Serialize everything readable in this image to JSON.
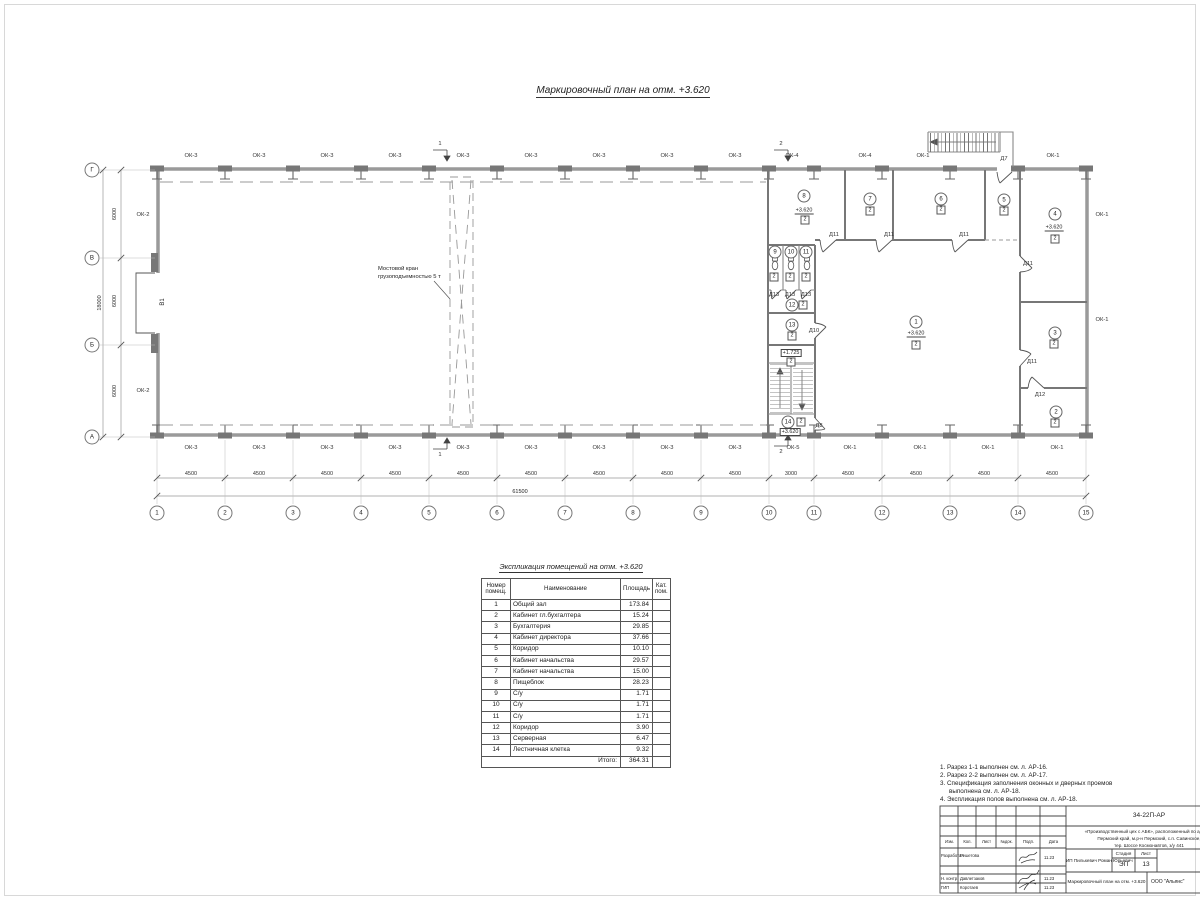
{
  "sheet": {
    "main_title": "Маркировочный план  на отм. +3.620",
    "table_title": "Экспликация помещений на отм. +3.620"
  },
  "plan": {
    "grid_cols": [
      {
        "t": "1",
        "x": 157,
        "y": 513
      },
      {
        "t": "2",
        "x": 225,
        "y": 513
      },
      {
        "t": "3",
        "x": 293,
        "y": 513
      },
      {
        "t": "4",
        "x": 361,
        "y": 513
      },
      {
        "t": "5",
        "x": 429,
        "y": 513
      },
      {
        "t": "6",
        "x": 497,
        "y": 513
      },
      {
        "t": "7",
        "x": 565,
        "y": 513
      },
      {
        "t": "8",
        "x": 633,
        "y": 513
      },
      {
        "t": "9",
        "x": 701,
        "y": 513
      },
      {
        "t": "10",
        "x": 769,
        "y": 513
      },
      {
        "t": "11",
        "x": 814,
        "y": 513
      },
      {
        "t": "12",
        "x": 882,
        "y": 513
      },
      {
        "t": "13",
        "x": 950,
        "y": 513
      },
      {
        "t": "14",
        "x": 1018,
        "y": 513
      },
      {
        "t": "15",
        "x": 1086,
        "y": 513
      }
    ],
    "grid_rows": [
      {
        "t": "Г",
        "x": 92,
        "y": 170
      },
      {
        "t": "В",
        "x": 92,
        "y": 258
      },
      {
        "t": "Б",
        "x": 92,
        "y": 345
      },
      {
        "t": "А",
        "x": 92,
        "y": 437
      }
    ],
    "span_dims": [
      {
        "t": "4500",
        "x": 191,
        "y": 474
      },
      {
        "t": "4500",
        "x": 259,
        "y": 474
      },
      {
        "t": "4500",
        "x": 327,
        "y": 474
      },
      {
        "t": "4500",
        "x": 395,
        "y": 474
      },
      {
        "t": "4500",
        "x": 463,
        "y": 474
      },
      {
        "t": "4500",
        "x": 531,
        "y": 474
      },
      {
        "t": "4500",
        "x": 599,
        "y": 474
      },
      {
        "t": "4500",
        "x": 667,
        "y": 474
      },
      {
        "t": "4500",
        "x": 735,
        "y": 474
      },
      {
        "t": "3000",
        "x": 791,
        "y": 474
      },
      {
        "t": "4500",
        "x": 848,
        "y": 474
      },
      {
        "t": "4500",
        "x": 916,
        "y": 474
      },
      {
        "t": "4500",
        "x": 984,
        "y": 474
      },
      {
        "t": "4500",
        "x": 1052,
        "y": 474
      }
    ],
    "total_dim": {
      "t": "61500"
    },
    "v_dims": [
      {
        "t": "6000",
        "x": 115,
        "y": 214
      },
      {
        "t": "6000",
        "x": 115,
        "y": 301
      },
      {
        "t": "6000",
        "x": 115,
        "y": 391
      },
      {
        "t": "18000",
        "x": 100,
        "y": 303
      }
    ],
    "ok_labels": [
      {
        "t": "ОК-3",
        "x": 191,
        "y": 156
      },
      {
        "t": "ОК-3",
        "x": 259,
        "y": 156
      },
      {
        "t": "ОК-3",
        "x": 327,
        "y": 156
      },
      {
        "t": "ОК-3",
        "x": 395,
        "y": 156
      },
      {
        "t": "ОК-3",
        "x": 463,
        "y": 156
      },
      {
        "t": "ОК-3",
        "x": 531,
        "y": 156
      },
      {
        "t": "ОК-3",
        "x": 599,
        "y": 156
      },
      {
        "t": "ОК-3",
        "x": 667,
        "y": 156
      },
      {
        "t": "ОК-3",
        "x": 735,
        "y": 156
      },
      {
        "t": "ОК-4",
        "x": 792,
        "y": 156
      },
      {
        "t": "ОК-4",
        "x": 865,
        "y": 156
      },
      {
        "t": "ОК-1",
        "x": 923,
        "y": 156
      },
      {
        "t": "ОК-1",
        "x": 1053,
        "y": 156
      },
      {
        "t": "ОК-3",
        "x": 191,
        "y": 448
      },
      {
        "t": "ОК-3",
        "x": 259,
        "y": 448
      },
      {
        "t": "ОК-3",
        "x": 327,
        "y": 448
      },
      {
        "t": "ОК-3",
        "x": 395,
        "y": 448
      },
      {
        "t": "ОК-3",
        "x": 463,
        "y": 448
      },
      {
        "t": "ОК-3",
        "x": 531,
        "y": 448
      },
      {
        "t": "ОК-3",
        "x": 599,
        "y": 448
      },
      {
        "t": "ОК-3",
        "x": 667,
        "y": 448
      },
      {
        "t": "ОК-3",
        "x": 735,
        "y": 448
      },
      {
        "t": "ОК-5",
        "x": 793,
        "y": 448
      },
      {
        "t": "ОК-1",
        "x": 850,
        "y": 448
      },
      {
        "t": "ОК-1",
        "x": 920,
        "y": 448
      },
      {
        "t": "ОК-1",
        "x": 988,
        "y": 448
      },
      {
        "t": "ОК-1",
        "x": 1057,
        "y": 448
      },
      {
        "t": "ОК-2",
        "x": 143,
        "y": 215
      },
      {
        "t": "ОК-2",
        "x": 143,
        "y": 391
      },
      {
        "t": "ОК-1",
        "x": 1102,
        "y": 215
      },
      {
        "t": "ОК-1",
        "x": 1102,
        "y": 320
      }
    ],
    "door_labels": [
      {
        "t": "Д7",
        "x": 1004,
        "y": 159
      },
      {
        "t": "Д8",
        "x": 819,
        "y": 426
      },
      {
        "t": "Д10",
        "x": 814,
        "y": 331
      },
      {
        "t": "Д11",
        "x": 834,
        "y": 235
      },
      {
        "t": "Д11",
        "x": 889,
        "y": 235
      },
      {
        "t": "Д11",
        "x": 964,
        "y": 235
      },
      {
        "t": "Д11",
        "x": 1028,
        "y": 264
      },
      {
        "t": "Д11",
        "x": 1032,
        "y": 362
      },
      {
        "t": "Д12",
        "x": 1040,
        "y": 395
      },
      {
        "t": "Д13",
        "x": 774,
        "y": 295
      },
      {
        "t": "Д13",
        "x": 790,
        "y": 295
      },
      {
        "t": "Д13",
        "x": 806,
        "y": 295
      }
    ],
    "room_circles": [
      {
        "t": "1",
        "x": 916,
        "y": 322
      },
      {
        "t": "2",
        "x": 1056,
        "y": 412
      },
      {
        "t": "3",
        "x": 1055,
        "y": 333
      },
      {
        "t": "4",
        "x": 1055,
        "y": 214
      },
      {
        "t": "5",
        "x": 1004,
        "y": 200
      },
      {
        "t": "6",
        "x": 941,
        "y": 199
      },
      {
        "t": "7",
        "x": 870,
        "y": 199
      },
      {
        "t": "8",
        "x": 804,
        "y": 196
      },
      {
        "t": "9",
        "x": 775,
        "y": 252
      },
      {
        "t": "10",
        "x": 791,
        "y": 252
      },
      {
        "t": "11",
        "x": 806,
        "y": 252
      },
      {
        "t": "12",
        "x": 792,
        "y": 305
      },
      {
        "t": "13",
        "x": 792,
        "y": 325
      },
      {
        "t": "14",
        "x": 788,
        "y": 422
      }
    ],
    "cat_boxes": [
      {
        "t": "2",
        "x": 805,
        "y": 220
      },
      {
        "t": "2",
        "x": 870,
        "y": 211
      },
      {
        "t": "2",
        "x": 941,
        "y": 210
      },
      {
        "t": "2",
        "x": 1004,
        "y": 211
      },
      {
        "t": "2",
        "x": 1055,
        "y": 239
      },
      {
        "t": "2",
        "x": 916,
        "y": 345
      },
      {
        "t": "2",
        "x": 1054,
        "y": 344
      },
      {
        "t": "2",
        "x": 1055,
        "y": 423
      },
      {
        "t": "2",
        "x": 803,
        "y": 305
      },
      {
        "t": "2",
        "x": 792,
        "y": 336
      },
      {
        "t": "2",
        "x": 801,
        "y": 422
      },
      {
        "t": "2",
        "x": 774,
        "y": 277
      },
      {
        "t": "2",
        "x": 790,
        "y": 277
      },
      {
        "t": "2",
        "x": 806,
        "y": 277
      },
      {
        "t": "2",
        "x": 791,
        "y": 362
      }
    ],
    "levels_underlined": [
      {
        "t": "+3.620",
        "x": 804,
        "y": 211
      },
      {
        "t": "+3.620",
        "x": 1054,
        "y": 228
      },
      {
        "t": "+3.620",
        "x": 916,
        "y": 334
      }
    ],
    "levels_boxed": [
      {
        "t": "+1.725",
        "x": 791,
        "y": 353
      },
      {
        "t": "+3.620",
        "x": 790,
        "y": 432
      }
    ],
    "section_digits": [
      {
        "t": "1",
        "x": 440,
        "y": 144
      },
      {
        "t": "1",
        "x": 440,
        "y": 455
      },
      {
        "t": "2",
        "x": 781,
        "y": 144
      },
      {
        "t": "2",
        "x": 781,
        "y": 452
      }
    ],
    "gate_label": {
      "t": "В1"
    },
    "crane_note": {
      "line1": "Мостовой кран",
      "line2": "грузоподъемностью 5 т"
    }
  },
  "table": {
    "headers": {
      "num": "Номер\nпомещ.",
      "name": "Наименование",
      "area": "Площадь",
      "cat": "Кат.\nпом."
    },
    "rows": [
      {
        "num": "1",
        "name": "Общий зал",
        "area": "173.84",
        "cat": ""
      },
      {
        "num": "2",
        "name": "Кабинет гл.бухгалтера",
        "area": "15.24",
        "cat": ""
      },
      {
        "num": "3",
        "name": "Бухгалтерия",
        "area": "29.85",
        "cat": ""
      },
      {
        "num": "4",
        "name": "Кабинет директора",
        "area": "37.66",
        "cat": ""
      },
      {
        "num": "5",
        "name": "Коридор",
        "area": "10.10",
        "cat": ""
      },
      {
        "num": "6",
        "name": "Кабинет начальства",
        "area": "29.57",
        "cat": ""
      },
      {
        "num": "7",
        "name": "Кабинет начальства",
        "area": "15.00",
        "cat": ""
      },
      {
        "num": "8",
        "name": "Пищеблок",
        "area": "28.23",
        "cat": ""
      },
      {
        "num": "9",
        "name": "С/у",
        "area": "1.71",
        "cat": ""
      },
      {
        "num": "10",
        "name": "С/у",
        "area": "1.71",
        "cat": ""
      },
      {
        "num": "11",
        "name": "С/у",
        "area": "1.71",
        "cat": ""
      },
      {
        "num": "12",
        "name": "Коридор",
        "area": "3.90",
        "cat": ""
      },
      {
        "num": "13",
        "name": "Серверная",
        "area": "6.47",
        "cat": ""
      },
      {
        "num": "14",
        "name": "Лестничная клетка",
        "area": "9.32",
        "cat": ""
      }
    ],
    "total_label": "Итого:",
    "total_value": "364.31"
  },
  "notes": [
    "1. Разрез 1-1 выполнен см. л. АР-16.",
    "2. Разрез 2-2 выполнен см. л. АР-17.",
    "3. Спецификация заполнения оконных и дверных проемов выполнена см. л. АР-18.",
    "4. Экспликация полов выполнена см. л. АР-18."
  ],
  "titleblock": {
    "doc": "34-22П-АР",
    "desc1": "«Производственный цех с АБК», расположенный по адресу:",
    "desc2": "Пермский край, м.р-н Пермский, с.п. Савинское,",
    "desc3": "тер. Шоссе Космонавтов, з/у 441",
    "cols": {
      "c1": "Изм.",
      "c2": "Кол.",
      "c3": "Лист",
      "c4": "№док.",
      "c5": "Подп.",
      "c6": "Дата"
    },
    "rows": [
      {
        "role": "Разработал",
        "name": "Решетова",
        "date": "11.23"
      },
      {
        "role": "Н. контр.",
        "name": "Давлетзаков",
        "date": "11.23"
      },
      {
        "role": "ГИП",
        "name": "Коротаев",
        "date": "11.23"
      }
    ],
    "client": "ИП Пилькевич Роман Юрьевич",
    "stage_label": "Стадия",
    "sheet_label": "Лист",
    "stage": "ЭП",
    "sheet_no": "13",
    "sheet_name": "Маркировочный план на отм. +3.620",
    "org": "ООО \"Альянс\""
  }
}
